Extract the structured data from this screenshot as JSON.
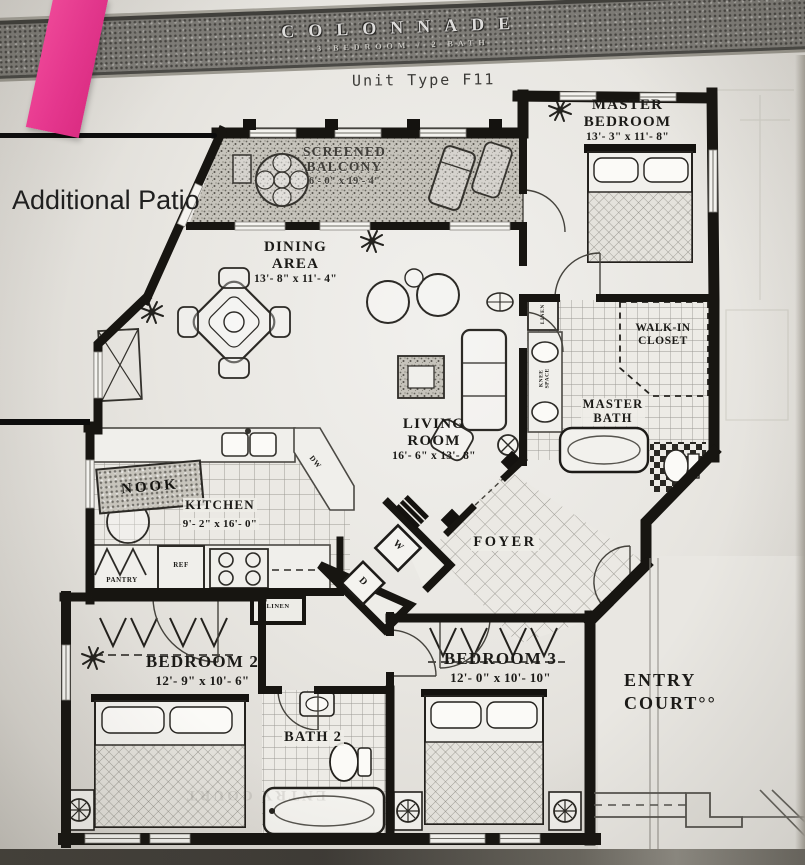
{
  "banner": {
    "title": "COLONNADE",
    "subtitle": "3 BEDROOM / 2 BATH"
  },
  "plan": {
    "unit_type": "Unit Type F11"
  },
  "annotation": {
    "patio_label": "Additional Patio"
  },
  "rooms": {
    "master_bedroom": {
      "name": "MASTER\nBEDROOM",
      "dims": "13'- 3\" x 11'- 8\""
    },
    "screened_balcony": {
      "name": "SCREENED\nBALCONY",
      "dims": "6'- 0\" x 19'- 4\""
    },
    "dining_area": {
      "name": "DINING\nAREA",
      "dims": "13'- 8\" x 11'- 4\""
    },
    "walk_in_closet": {
      "name": "WALK-IN\nCLOSET"
    },
    "master_bath": {
      "name": "MASTER\nBATH"
    },
    "living_room": {
      "name": "LIVING\nROOM",
      "dims": "16'- 6\" x 13'- 8\""
    },
    "nook": {
      "name": "NOOK"
    },
    "kitchen": {
      "name": "KITCHEN",
      "dims": "9'- 2\" x 16'- 0\""
    },
    "foyer": {
      "name": "FOYER"
    },
    "bedroom_2": {
      "name": "BEDROOM 2",
      "dims": "12'- 9\" x 10'- 6\""
    },
    "bath_2": {
      "name": "BATH 2"
    },
    "bedroom_3": {
      "name": "BEDROOM 3",
      "dims": "12'- 0\" x 10'- 10\""
    },
    "entry_court": {
      "name": "ENTRY\nCOURT°°"
    }
  },
  "fixtures": {
    "pantry": "PANTRY",
    "refrigerator": "REF",
    "linen_hall": "LINEN",
    "linen_bath": "LINEN",
    "knee_space": "KNEE\nSPACE",
    "washer": "W",
    "dryer": "D",
    "dishwasher": "DW"
  },
  "bleed_through": {
    "ghost_text": "ENTRY COURT"
  },
  "colors": {
    "sticky_note": "#ee3793",
    "wall_ink": "#171511",
    "annotation_ink": "#0c0c0c"
  }
}
